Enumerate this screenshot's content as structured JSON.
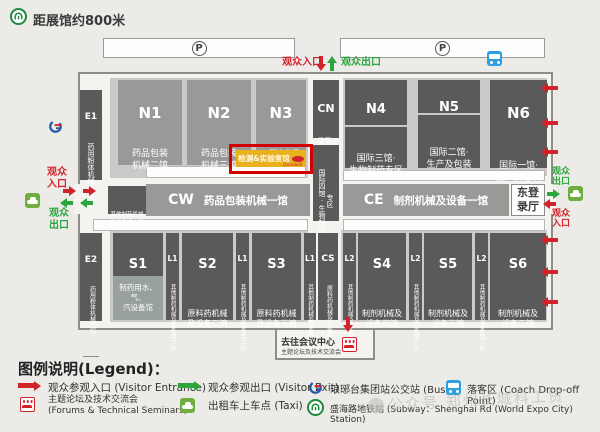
{
  "header": {
    "metro_note": "距展馆约800米",
    "parking_label": "P",
    "entrance_label": "观众入口",
    "exit_label": "观众出口"
  },
  "west": {
    "entrance": "观众\n入口",
    "exit": "观众\n出口"
  },
  "east": {
    "exit": "观众\n出口",
    "entrance": "观众\n入口",
    "hall": "东登\n录厅"
  },
  "halls": {
    "e1": {
      "id": "E1",
      "name": "药用粉体机械一馆"
    },
    "e2": {
      "id": "E2",
      "name": "药用粉体机械二馆",
      "name2": "饮片机械馆"
    },
    "n1": {
      "id": "N1",
      "name": "药品包装\n机械二馆"
    },
    "n2": {
      "id": "N2",
      "name": "药品包装\n机械三馆"
    },
    "n3": {
      "id": "N3",
      "name": "工程净化及\n环保设备馆"
    },
    "cn": {
      "id": "CN",
      "name": "国际四馆·工程自动化净化配套实验室",
      "lower": "国际四馆·生物制药专区"
    },
    "n4": {
      "id": "N4",
      "top": "国际三馆·\n工程自动化净化\n配套实验室",
      "bottom": "国际三馆·\n生物制药专区"
    },
    "n5": {
      "id": "N5",
      "top": "国际二馆·\n工程自动化净化\n配套实验室",
      "bottom": "国际二馆·\n生产及包装"
    },
    "n6": {
      "id": "N6",
      "name": "国际一馆·\n生产及包装"
    },
    "cw": {
      "id": "CW",
      "name": "药品包装机械一馆",
      "side": "其他制药机械\n及设备馆一区"
    },
    "ce": {
      "id": "CE",
      "name": "制剂机械及设备一馆"
    },
    "s1": {
      "id": "S1",
      "name": "原料药机械\n及设备一馆",
      "sub": "制药用水、气、\n汽设备馆"
    },
    "s2": {
      "id": "S2",
      "name": "原料药机械\n及设备二馆"
    },
    "s3": {
      "id": "S3",
      "name": "原料药机械\n及设备三馆"
    },
    "cs": {
      "id": "CS",
      "name": "原料药机械及设备四馆"
    },
    "s4": {
      "id": "S4",
      "name": "制剂机械及\n设备四馆"
    },
    "s5": {
      "id": "S5",
      "name": "制剂机械及\n设备三馆"
    },
    "s6": {
      "id": "S6",
      "name": "制剂机械及\n设备二馆"
    },
    "l1": {
      "id": "L1",
      "name": "其他制药机械及设备馆二区"
    },
    "l2": {
      "id": "L2",
      "name": "其他制药机械及设备馆三区"
    }
  },
  "highlight": {
    "name": "检测&实验室馆",
    "logo": "Goodwill"
  },
  "conference": {
    "title": "去往会议中心",
    "subtitle": "主题论坛及技术交流会"
  },
  "legend": {
    "title": "图例说明(Legend)：",
    "entrance": "观众参观入口 (Visitor Entrance)",
    "exit": "观众参观出口 (Visitor Exit)",
    "forum_cn": "主题论坛及技术交流会",
    "forum_en": "(Forums & Technical Seminars)",
    "taxi": "出租车上车点 (Taxi)",
    "bus": "琅琊台集团站公交站 (Bus)",
    "coach": "落客区 (Coach Drop-off Point)",
    "subway": "盛海路地铁站 (Subway：Shenghai Rd (World Expo City) Station)"
  },
  "watermark": "公众号 郑州长城科工贸"
}
